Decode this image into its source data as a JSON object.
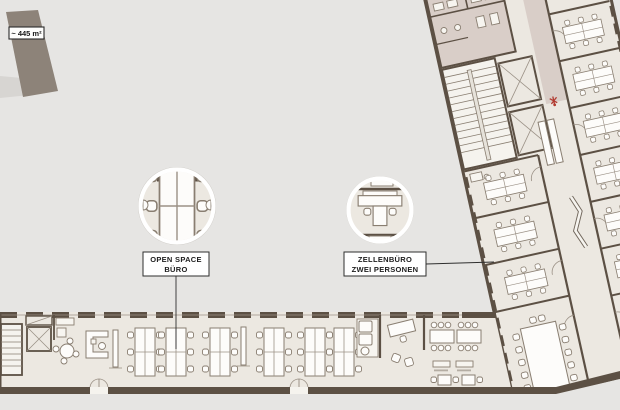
{
  "page": {
    "type": "architectural-floor-plan",
    "description": "Office floor plan with open space and two-person cell offices"
  },
  "colors": {
    "background": "#e6e5e3",
    "floor": "#ece8e1",
    "wall": "#5c5044",
    "corridor": "#d9cec8",
    "massing": "#8d8379",
    "canopy": "#d7d5d2",
    "furniture_stroke": "#897e71",
    "accent_red": "#b23b31",
    "callout_border": "#2e2e2e",
    "circle_ring": "#ffffff"
  },
  "area_badge": {
    "label": "~ 445 m²"
  },
  "callouts": [
    {
      "id": "open-space-buero",
      "line1": "OPEN SPACE",
      "line2": "BÜRO"
    },
    {
      "id": "zellenbuero",
      "line1": "ZELLENBÜRO",
      "line2": "ZWEI PERSONEN"
    }
  ]
}
